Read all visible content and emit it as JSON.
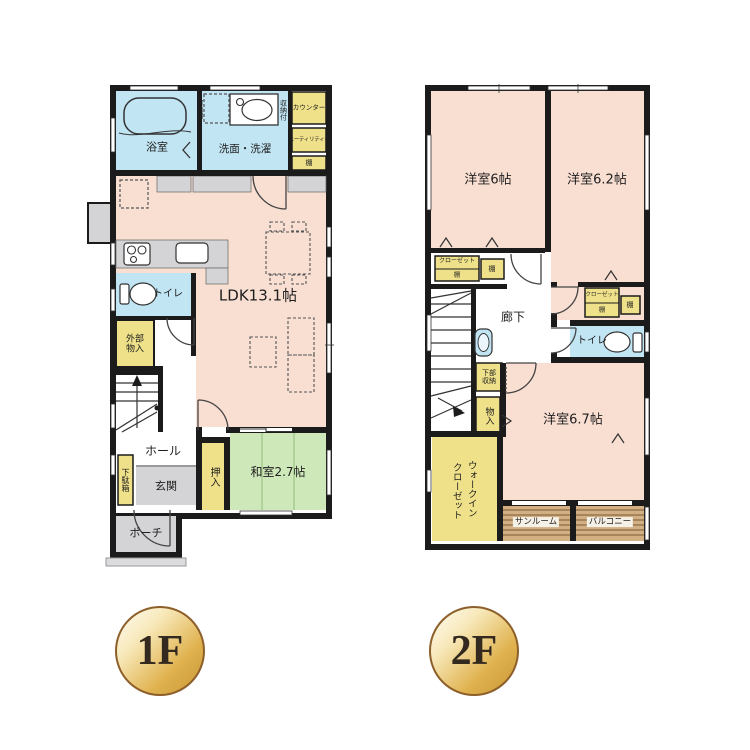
{
  "f1": {
    "badge": "1F",
    "rooms": {
      "bath": "浴室",
      "washroom": "洗面・洗濯",
      "movable_shelf": "可動棚",
      "with_storage": "収納付",
      "counter": "カウンター",
      "utility": "ユーティリティー",
      "shelf": "棚",
      "ldk": "LDK13.1帖",
      "toilet": "トイレ",
      "exterior_storage": "外部物入",
      "hall": "ホール",
      "shoebox": "下駄箱",
      "entrance": "玄関",
      "oshiire": "押入",
      "japanese_room": "和室2.7帖",
      "porch": "ポーチ"
    }
  },
  "f2": {
    "badge": "2F",
    "rooms": {
      "room_6": "洋室6帖",
      "room_6_2": "洋室6.2帖",
      "room_6_7": "洋室6.7帖",
      "closet": "クローゼット",
      "shelf": "棚",
      "hallway": "廊下",
      "toilet": "トイレ",
      "under_storage": "下部収納",
      "storage": "物入",
      "wic_line1": "ウォークイン",
      "wic_line2": "クローゼット",
      "sunroom": "サンルーム",
      "balcony": "バルコニー"
    }
  },
  "palette": {
    "wall": "#1b1b1b",
    "room_pink": "#f9ded2",
    "wet_blue": "#c2e5f4",
    "storage_yellow": "#efe18a",
    "tatami_green": "#cfe8b9",
    "gray": "#d4d4d6",
    "deck_tan": "#d2b084",
    "badge_gold": "#d4a437"
  }
}
